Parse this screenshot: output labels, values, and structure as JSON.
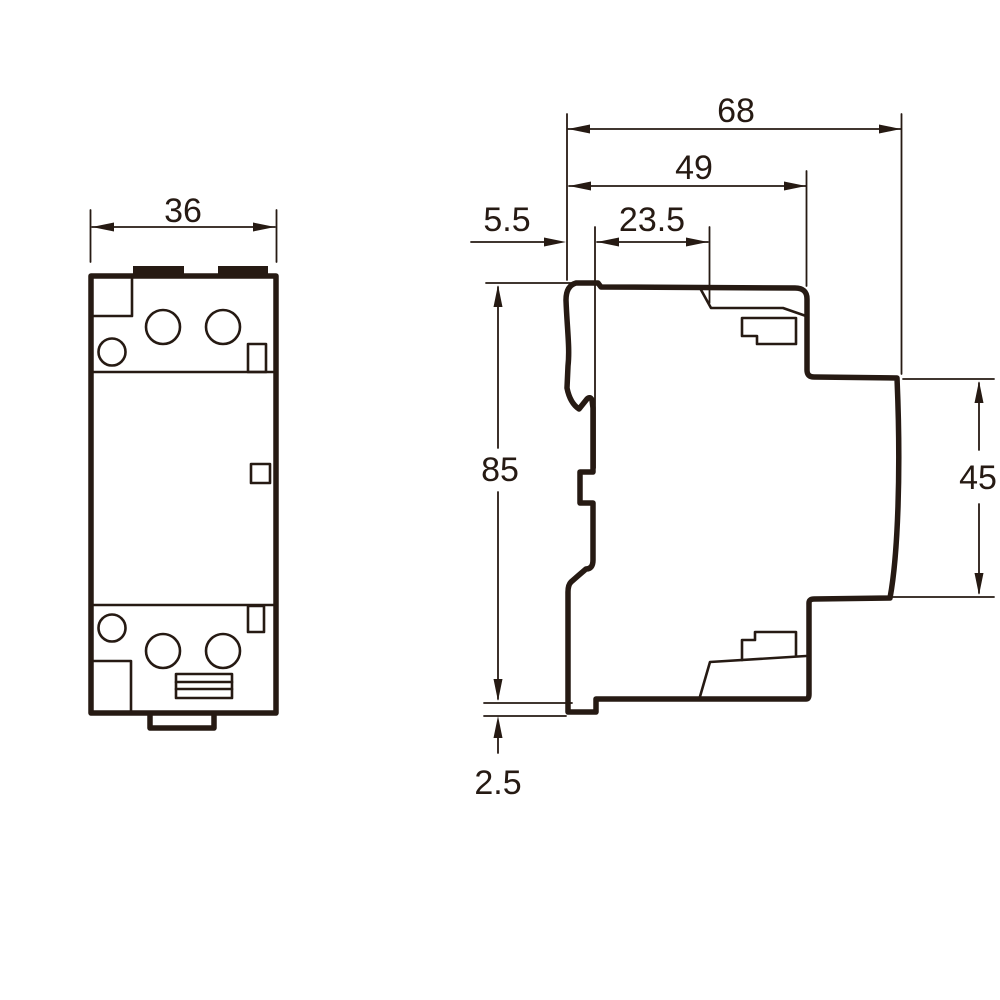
{
  "colors": {
    "line": "#261a13",
    "background": "#ffffff"
  },
  "drawing": {
    "type": "technical-dimension-drawing",
    "views": [
      "front-view",
      "side-view"
    ]
  },
  "dimensions": {
    "front_width": "36",
    "total_depth": "68",
    "upper_depth": "49",
    "front_offset": "5.5",
    "recess_depth": "23.5",
    "overall_height": "85",
    "rear_height": "45",
    "rail_clip_depth": "2.5"
  }
}
